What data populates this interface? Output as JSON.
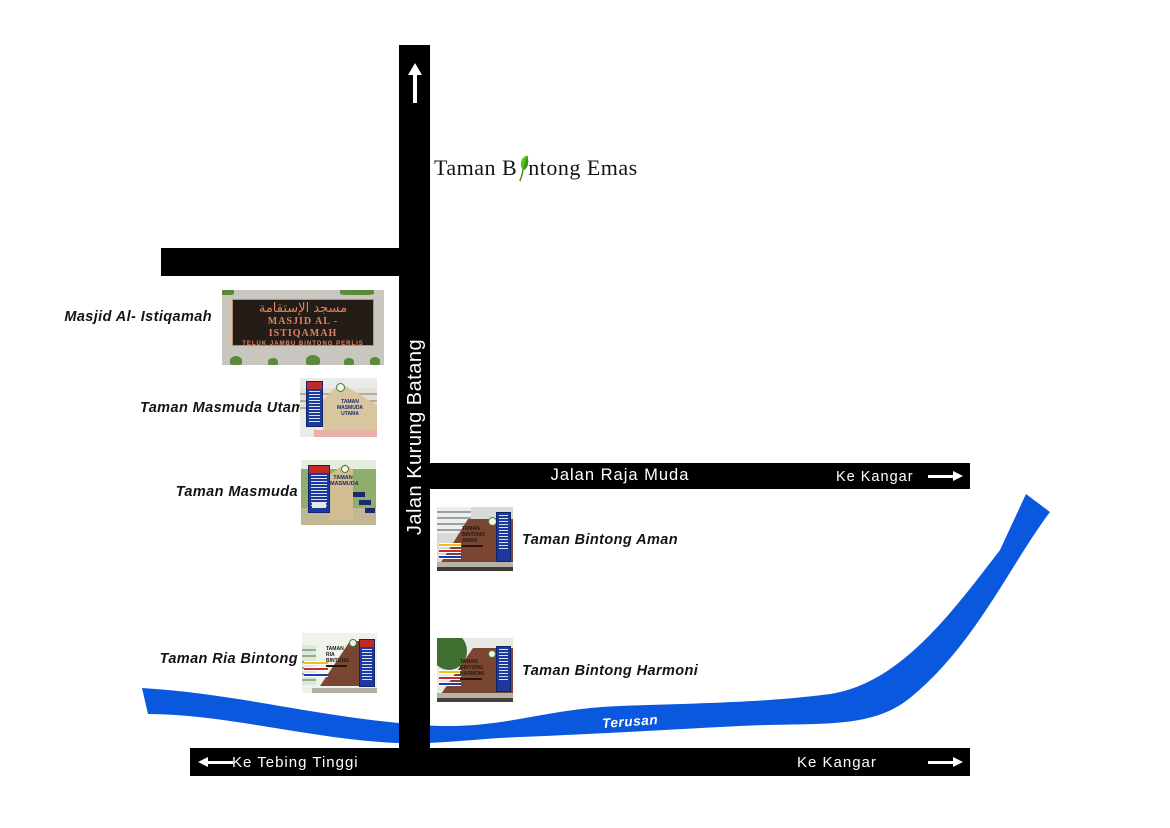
{
  "title": {
    "part1": "Taman B",
    "part2": "ntong Emas",
    "full": "Taman Bintong Emas"
  },
  "roads": {
    "vertical": {
      "name": "Jalan Kurung Batang"
    },
    "raja_muda": {
      "name": "Jalan Raja Muda",
      "direction": "Ke Kangar"
    },
    "bottom": {
      "left_direction": "Ke Tebing Tinggi",
      "right_direction": "Ke Kangar"
    }
  },
  "canal": {
    "name": "Terusan",
    "color": "#0A58DE"
  },
  "landmarks": {
    "masjid": {
      "label": "Masjid Al- Istiqamah"
    },
    "masmuda_utama": {
      "label": "Taman Masmuda Utama"
    },
    "masmuda": {
      "label": "Taman Masmuda"
    },
    "ria_bintong": {
      "label": "Taman Ria Bintong"
    },
    "bintong_aman": {
      "label": "Taman Bintong Aman"
    },
    "bintong_harmoni": {
      "label": "Taman Bintong Harmoni"
    }
  },
  "signs": {
    "masjid": {
      "arabic": "مسجد الإستقامة",
      "line1": "MASJID AL - ISTIQAMAH",
      "line2": "TELUK JAMBU BINTONG PERLIS"
    },
    "masmuda_utama": {
      "line1": "TAMAN",
      "line2": "MASMUDA UTAMA"
    },
    "masmuda": {
      "line1": "TAMAN",
      "line2": "MASMUDA"
    },
    "bintong_aman": {
      "line1": "TAMAN",
      "line2": "BINTONG",
      "line3": "AMAN"
    },
    "ria_bintong": {
      "line1": "TAMAN",
      "line2": "RIA",
      "line3": "BINTONG"
    },
    "bintong_harmoni": {
      "line1": "TAMAN",
      "line2": "BINTONG",
      "line3": "HARMONI"
    }
  },
  "colors": {
    "road": "#000000",
    "road_text": "#FFFFFF",
    "canal_blue": "#0A58DE",
    "leaf_green": "#55B41E",
    "sign_board_text": "#DD8260",
    "monument_brown": "#7A4632",
    "monument_tan": "#D8C79E"
  }
}
